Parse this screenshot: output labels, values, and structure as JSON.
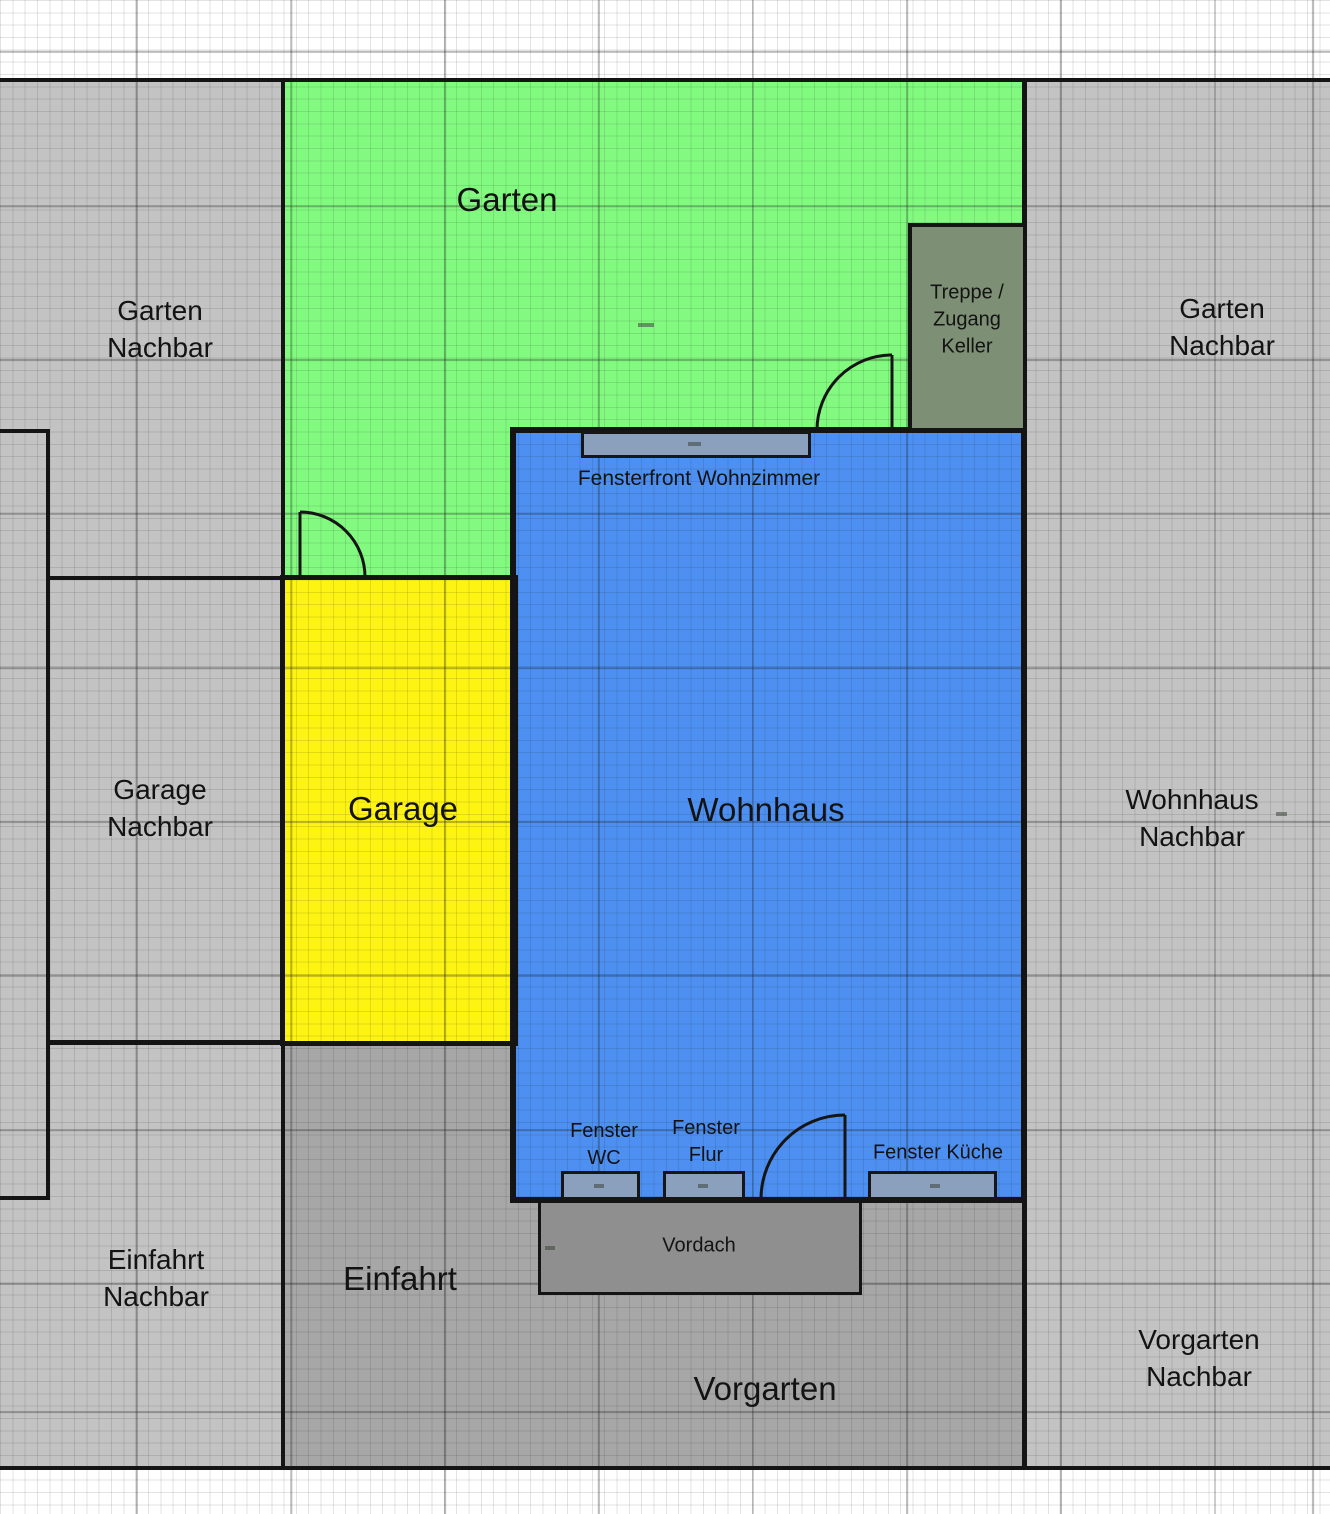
{
  "regions": {
    "garten": "Garten",
    "garage": "Garage",
    "wohnhaus": "Wohnhaus",
    "einfahrt": "Einfahrt",
    "vorgarten": "Vorgarten"
  },
  "neighbors": {
    "garten_left": {
      "line1": "Garten",
      "line2": "Nachbar"
    },
    "garten_right": {
      "line1": "Garten",
      "line2": "Nachbar"
    },
    "garage": {
      "line1": "Garage",
      "line2": "Nachbar"
    },
    "wohnhaus": {
      "line1": "Wohnhaus",
      "line2": "Nachbar"
    },
    "einfahrt": {
      "line1": "Einfahrt",
      "line2": "Nachbar"
    },
    "vorgarten": {
      "line1": "Vorgarten",
      "line2": "Nachbar"
    }
  },
  "features": {
    "treppe": {
      "line1": "Treppe /",
      "line2": "Zugang",
      "line3": "Keller"
    },
    "fensterfront": "Fensterfront Wohnzimmer",
    "fenster_wc": {
      "line1": "Fenster",
      "line2": "WC"
    },
    "fenster_flur": {
      "line1": "Fenster",
      "line2": "Flur"
    },
    "fenster_kueche": "Fenster Küche",
    "vordach": "Vordach"
  },
  "colors": {
    "garten_green": "#82fa80",
    "garage_yellow": "#fdf414",
    "wohnhaus_blue": "#4d90f1",
    "neighbor_gray": "#c3c3c3",
    "paved_gray": "#a7a7a7",
    "vordach_gray": "#8f8f8f",
    "treppe_gray_green": "#7d8f74",
    "window_fill": "#8ba0bc",
    "boundary_black": "#141414"
  }
}
